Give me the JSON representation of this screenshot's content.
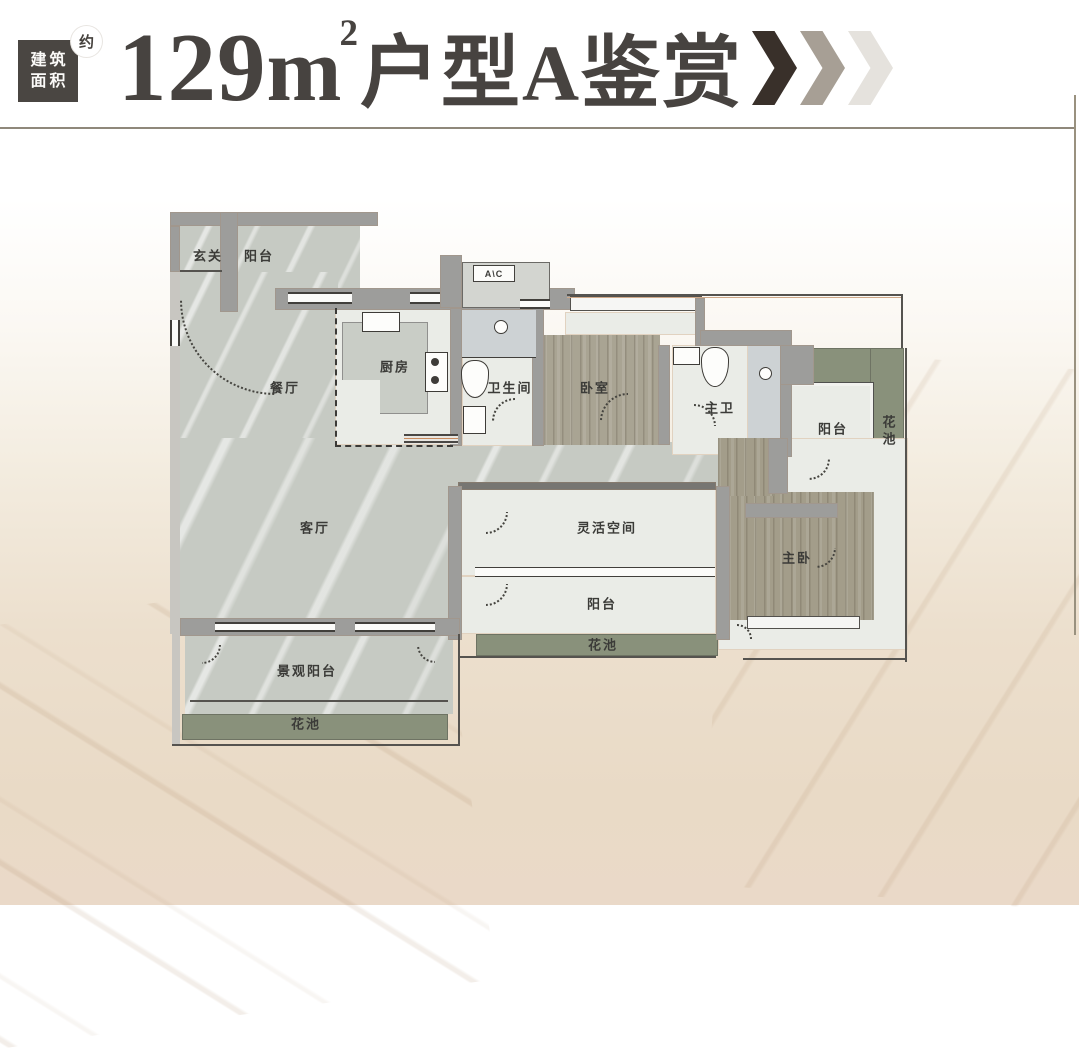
{
  "header": {
    "badge": {
      "line1": "建筑",
      "line2": "面积",
      "approx": "约"
    },
    "title": {
      "area": "129",
      "unit": "m",
      "sup": "2",
      "name": "户型A鉴赏"
    },
    "chevron_colors": [
      "#39302a",
      "#a79f95",
      "#e5e2dd"
    ]
  },
  "plan": {
    "ac_label": "A\\C",
    "rooms": {
      "entry": "玄关",
      "balcony_top": "阳台",
      "dining": "餐厅",
      "kitchen": "厨房",
      "bathroom": "卫生间",
      "bedroom": "卧室",
      "master_bath": "主卫",
      "balcony_right": "阳台",
      "flower_right": "花池",
      "living": "客厅",
      "flex_space": "灵活空间",
      "master_bedroom": "主卧",
      "balcony_mid": "阳台",
      "flower_mid": "花池",
      "view_balcony": "景观阳台",
      "flower_left": "花池"
    }
  },
  "colors": {
    "title_text": "#474340",
    "wall": "#9d9d9b",
    "marble_floor": "#c6cac3",
    "wood_floor": "#a9a493",
    "flower_bed": "#89917b",
    "light_floor": "#eaece7",
    "header_rule": "#8f887b"
  }
}
